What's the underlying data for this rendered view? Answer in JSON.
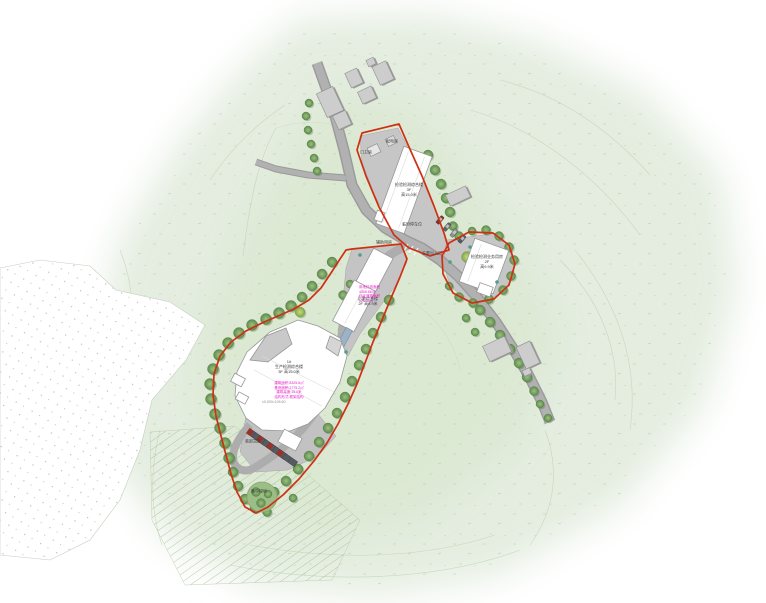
{
  "drawing": {
    "type_hint": "architectural site master plan",
    "colors": {
      "site_boundary_red": "#cf2f12",
      "note_pink": "#e81ec9",
      "road_gray": "#a8a8a8",
      "pavement_gray": "#c6c6c6",
      "tree_green": "#74a05e",
      "terrain_green": "#e3ecdb",
      "building_white": "#ffffff",
      "existing_building_gray": "#cdcdcd"
    }
  },
  "labels": {
    "power_room": "配电房",
    "guard_room": "门卫房",
    "aux_room": "辅助用房",
    "temp_parking": "临时停车位",
    "main_entrance": "主要出入口",
    "bldg2_name": "检验检测综合楼",
    "bldg2_floors": "3F",
    "bldg2_height": "高15.0米",
    "bldg3_name": "检验检测业务用房",
    "bldg3_floors": "2F",
    "bldg3_height": "高9.9米",
    "bldg4_name": "后勤综合楼",
    "bldg4_spec": "2F 高9.9米",
    "note_mid_1": "用地红线面积",
    "note_mid_2": "4308.86㎡",
    "note_mid_3": "代征道路面积",
    "note_mid_4": "126.00㎡",
    "bldg1_no": "1#",
    "bldg1_name": "生产检测综合楼",
    "bldg1_spec": "3F 高15.0米",
    "note_main_1": "建筑面积:8325.6㎡",
    "note_main_2": "基底面积:2775.2㎡",
    "note_main_3": "建筑高度:15.0米",
    "note_main_4": "结构形式:框架结构",
    "elev_note": "±0.000=105.50",
    "loading_area": "装卸货区",
    "green_area": "集中绿地"
  }
}
